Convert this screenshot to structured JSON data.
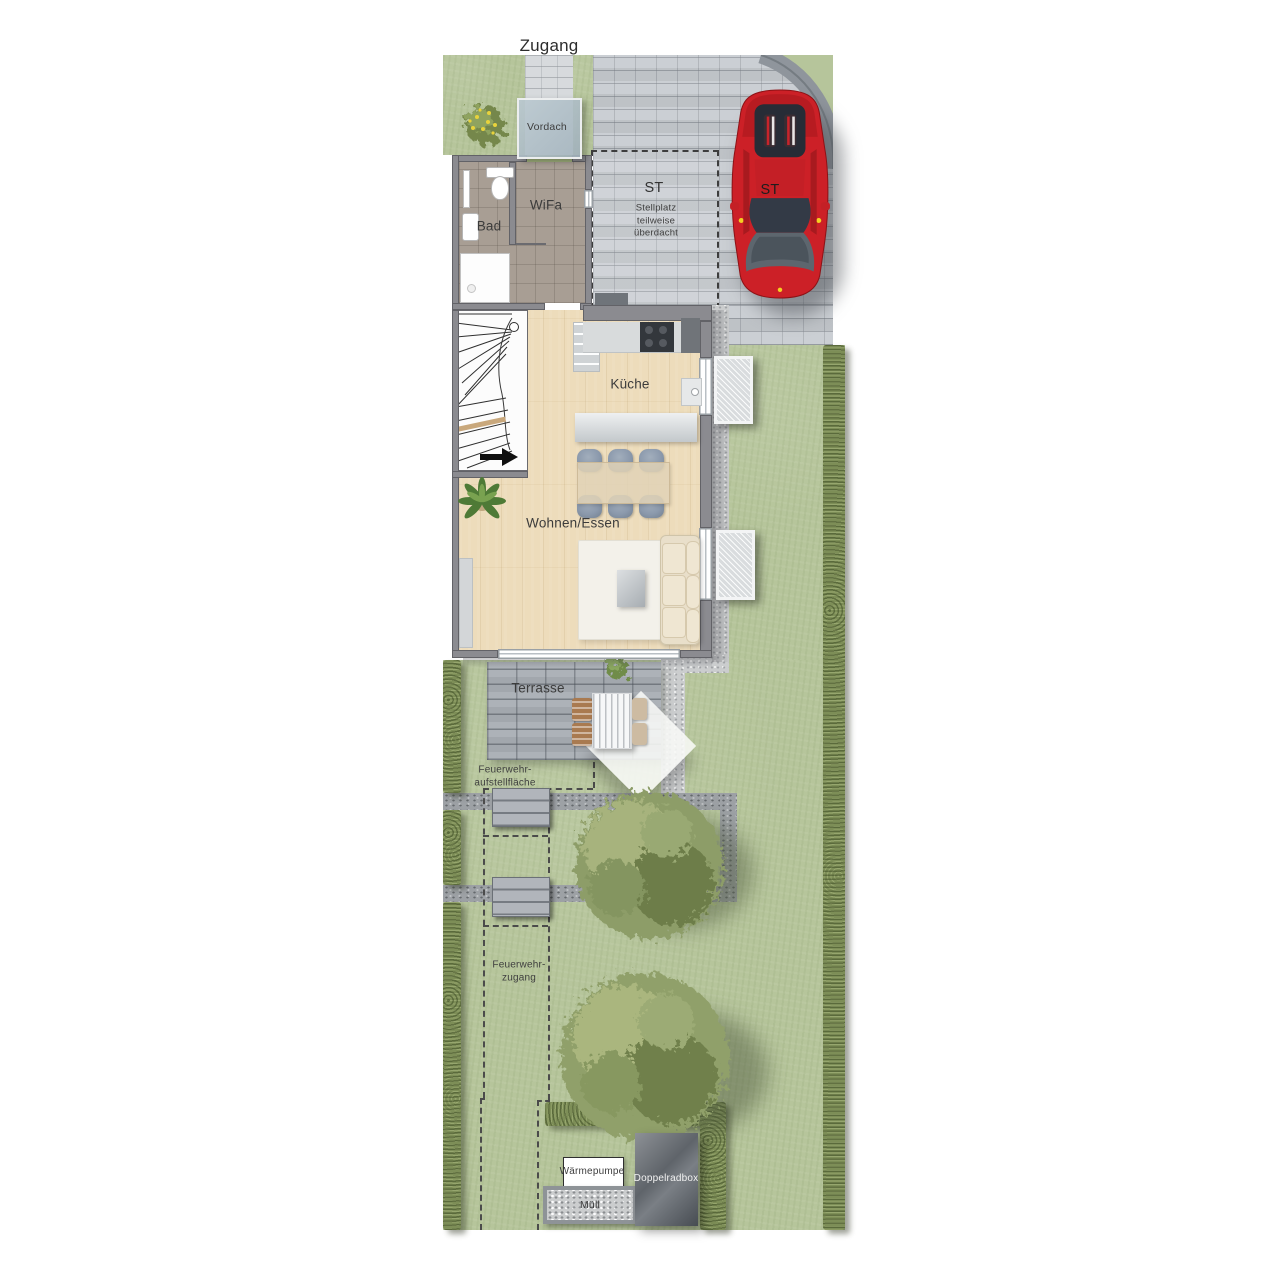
{
  "labels": {
    "zugang": "Zugang",
    "vordach": "Vordach",
    "bad": "Bad",
    "wifa": "WiFa",
    "st_parking": "ST",
    "st_car": "ST",
    "stellplatz_note_line1": "Stellplatz",
    "stellplatz_note_line2": "teilweise",
    "stellplatz_note_line3": "überdacht",
    "kueche": "Küche",
    "wohnen_essen": "Wohnen/Essen",
    "terrasse": "Terrasse",
    "feuerwehr_aufstellflaeche_line1": "Feuerwehr-",
    "feuerwehr_aufstellflaeche_line2": "aufstellfläche",
    "feuerwehr_zugang_line1": "Feuerwehr-",
    "feuerwehr_zugang_line2": "zugang",
    "waermepumpe": "Wärmepumpe",
    "muell": "Müll",
    "doppelradbox": "Doppelradbox"
  },
  "colors": {
    "grass": "#b6c59b",
    "hedge": "#7d8e57",
    "paving": "#c8ccd1",
    "paving_band": "#8f959c",
    "terrace_paving": "#a9aeb4",
    "gravel_path": "#9da1a5",
    "pebble_strip": "#cbcdce",
    "wall": "#8b8b90",
    "tile_floor": "#a89e94",
    "wood_floor": "#eddcbb",
    "glass_canopy": "#b9c7cd",
    "car_red": "#cc2027",
    "tree_foliage": "#97a571",
    "label_text": "#3b3b3b",
    "dark_box": "#5f646a"
  }
}
